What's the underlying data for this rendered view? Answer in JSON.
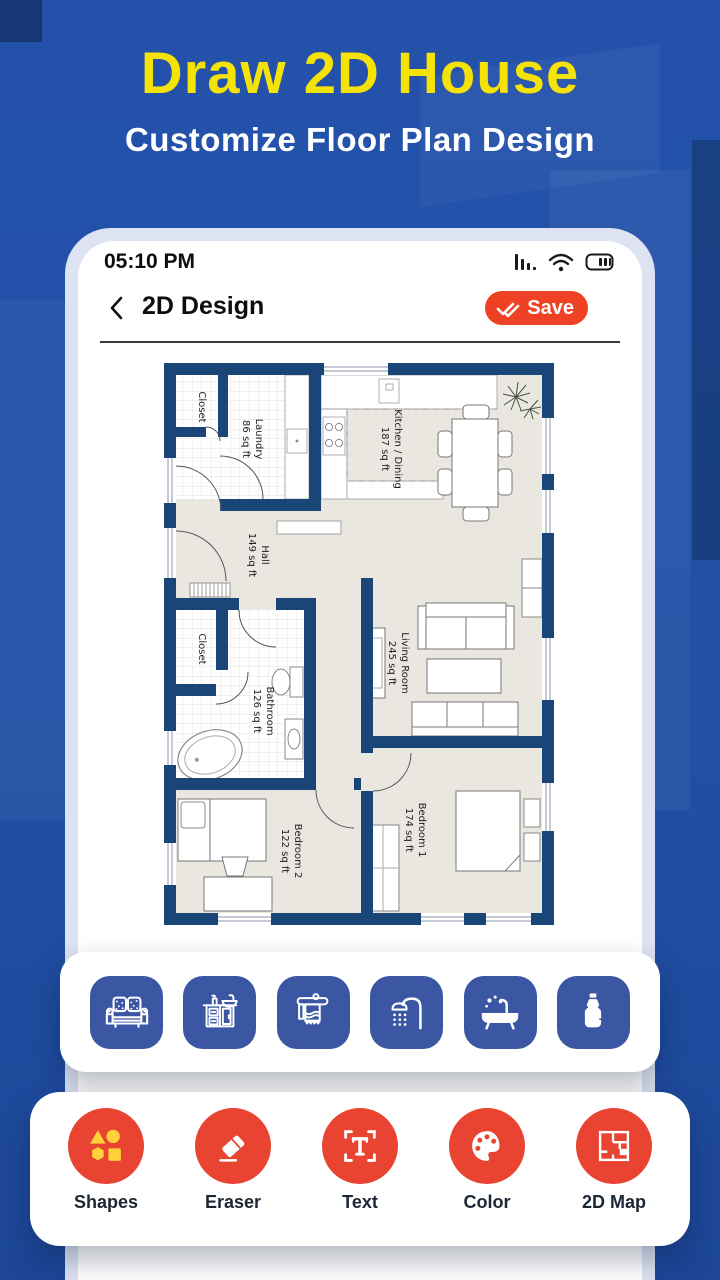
{
  "hero": {
    "title": "Draw 2D House",
    "subtitle": "Customize Floor Plan Design"
  },
  "statusbar": {
    "time": "05:10 PM",
    "icons": [
      "cell-signal-icon",
      "wifi-icon",
      "battery-icon"
    ]
  },
  "header": {
    "title": "2D Design",
    "save_label": "Save"
  },
  "plan": {
    "rooms": {
      "closet1": {
        "name": "Closet"
      },
      "laundry": {
        "name": "Laundry",
        "area": "86 sq ft"
      },
      "kitchen": {
        "name": "Kitchen / Dining",
        "area": "187 sq ft"
      },
      "hall": {
        "name": "Hall",
        "area": "149 sq ft"
      },
      "closet2": {
        "name": "Closet"
      },
      "bathroom": {
        "name": "Bathroom",
        "area": "126 sq ft"
      },
      "living": {
        "name": "Living Room",
        "area": "245 sq ft"
      },
      "bedroom2": {
        "name": "Bedroom 2",
        "area": "122 sq ft"
      },
      "bedroom1": {
        "name": "Bedroom 1",
        "area": "174 sq ft"
      }
    }
  },
  "furniture_toolbar": {
    "items": [
      {
        "icon": "sofa-icon"
      },
      {
        "icon": "kitchen-sink-icon"
      },
      {
        "icon": "towel-rack-icon"
      },
      {
        "icon": "shower-icon"
      },
      {
        "icon": "bathtub-icon"
      },
      {
        "icon": "water-bottle-icon"
      }
    ]
  },
  "tools": {
    "items": [
      {
        "icon": "shapes-icon",
        "label": "Shapes"
      },
      {
        "icon": "eraser-icon",
        "label": "Eraser"
      },
      {
        "icon": "text-icon",
        "label": "Text"
      },
      {
        "icon": "color-icon",
        "label": "Color"
      },
      {
        "icon": "map-2d-icon",
        "label": "2D Map"
      }
    ]
  },
  "colors": {
    "background": "#2150a6",
    "title_yellow": "#f5e206",
    "accent_red": "#e94431",
    "save_red": "#ef4123",
    "tile_blue": "#3b56a3",
    "wall_navy": "#1a4577",
    "floor": "#eae7e0"
  }
}
